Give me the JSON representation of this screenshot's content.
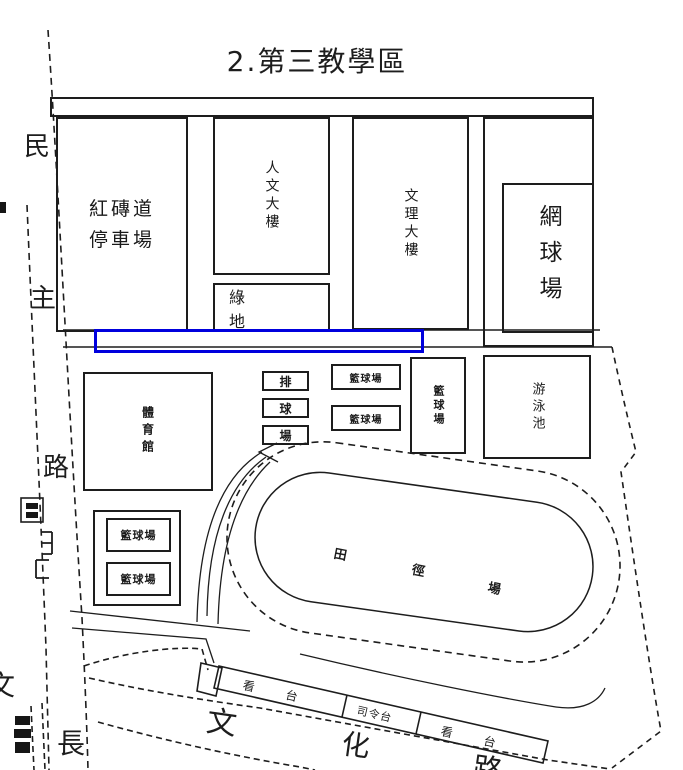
{
  "title": "2.第三教學區",
  "highlight_box": {
    "color": "#0000dd"
  },
  "buildings": {
    "parking": {
      "line1": "紅磚道",
      "line2": "停車場"
    },
    "humanities": {
      "label": "人文大樓"
    },
    "green_space": {
      "label": "綠地"
    },
    "liberal_arts": {
      "label": "文理大樓"
    },
    "tennis": {
      "label": "網球場"
    },
    "gym": {
      "label": "體育館"
    },
    "volleyball": {
      "chars": [
        "排",
        "球",
        "場"
      ]
    },
    "basketball_mid_1": {
      "label": "籃球場"
    },
    "basketball_mid_2": {
      "label": "籃球場"
    },
    "basketball_east": {
      "label": "籃球場"
    },
    "pool": {
      "label": "游泳池"
    },
    "basketball_sw_1": {
      "label": "籃球場"
    },
    "basketball_sw_2": {
      "label": "籃球場"
    },
    "track": {
      "chars": [
        "田",
        "徑",
        "場"
      ]
    },
    "stands_left": {
      "label": "看台"
    },
    "podium": {
      "label": "司令台"
    },
    "stands_right": {
      "label": "看台"
    }
  },
  "roads": {
    "west": {
      "chars": [
        "民",
        "主",
        "路"
      ]
    },
    "south": {
      "chars": [
        "文",
        "化",
        "路"
      ]
    },
    "southwest": {
      "char": "長",
      "partial_edge_char": "文"
    }
  },
  "illegible_marks": [
    "west-road-small-box-label",
    "west-road-gate-glyphs",
    "southwest-corner-blob",
    "left-edge-tick"
  ]
}
